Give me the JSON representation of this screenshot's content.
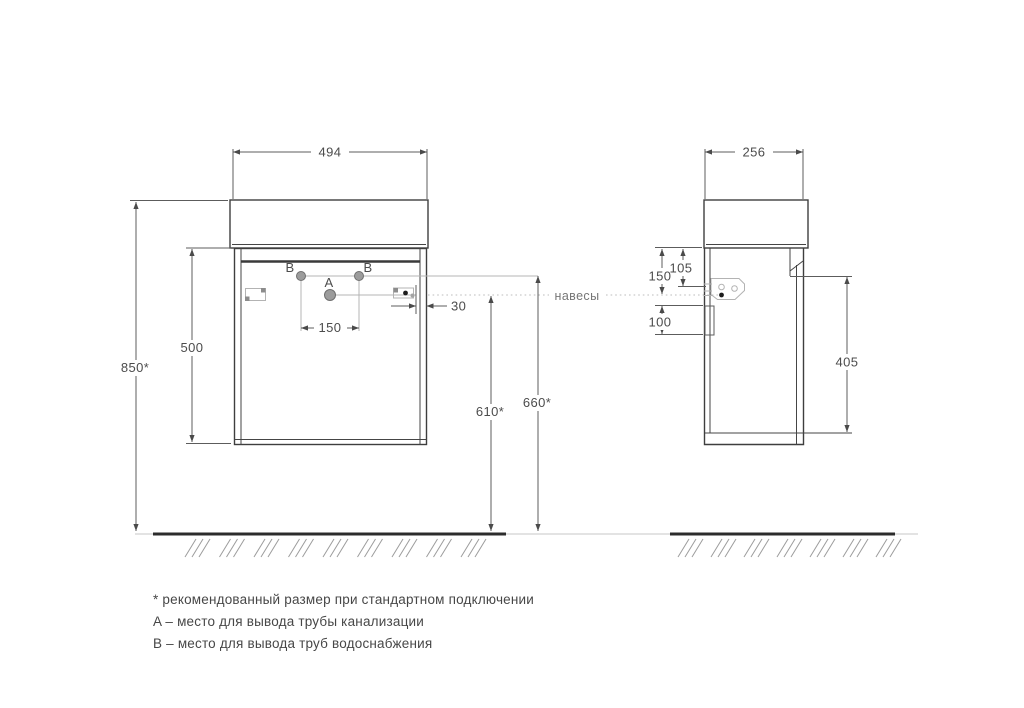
{
  "front": {
    "dim_width": "494",
    "dim_total_height": "850*",
    "dim_carcass_height": "500",
    "dim_holes_spacing": "150",
    "dim_bracket_offset": "30",
    "dim_drain_height": "610*",
    "dim_supply_height": "660*",
    "label_a": "A",
    "label_b_left": "B",
    "label_b_right": "B"
  },
  "side": {
    "dim_depth": "256",
    "dim_hanger_level": "150",
    "dim_bracket_top": "105",
    "dim_rail": "100",
    "dim_door_height": "405"
  },
  "callout_hangers": "навесы",
  "legend": {
    "note_asterisk": "* рекомендованный размер при стандартном подключении",
    "note_a": "A – место для вывода трубы канализации",
    "note_b": "B – место для вывода труб водоснабжения"
  },
  "colors": {
    "outline": "#3e3e3e",
    "dimension": "#5c5c5c",
    "thin_connector": "#b4b4b4",
    "text": "#4c4c4c",
    "muted_text": "#767676",
    "hole_fill": "#9c9c9c",
    "ground": "#2c2c2c"
  }
}
